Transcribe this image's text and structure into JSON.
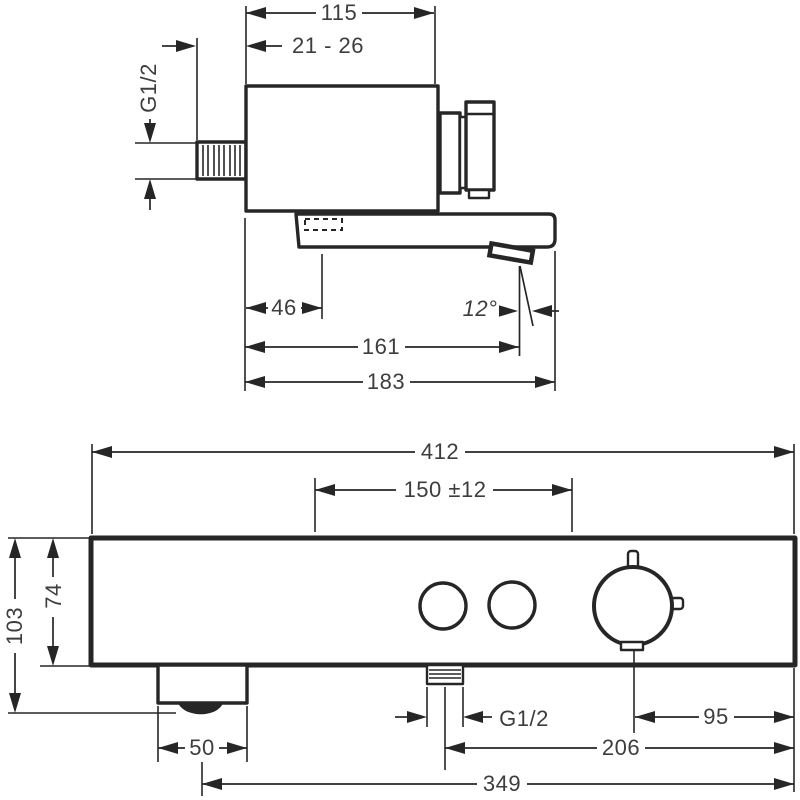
{
  "views": {
    "side": {
      "dim_faceplate_width": "115",
      "dim_wall_clearance": "21 - 26",
      "dim_inlet_thread": "G1/2",
      "dim_slot_offset": "46",
      "dim_spout_angle": "12°",
      "dim_spout_reach": "161",
      "dim_total_depth": "183"
    },
    "front": {
      "dim_total_width": "412",
      "dim_inlet_centers": "150 ±12",
      "dim_total_height": "103",
      "dim_body_height": "74",
      "dim_foot_width": "50",
      "dim_outlet_thread": "G1/2",
      "dim_knob_to_edge": "95",
      "dim_outlet_to_edge": "206",
      "dim_foot_to_edge": "349"
    }
  },
  "colors": {
    "line": "#262626",
    "text": "#3d3d3d",
    "background": "#ffffff"
  }
}
